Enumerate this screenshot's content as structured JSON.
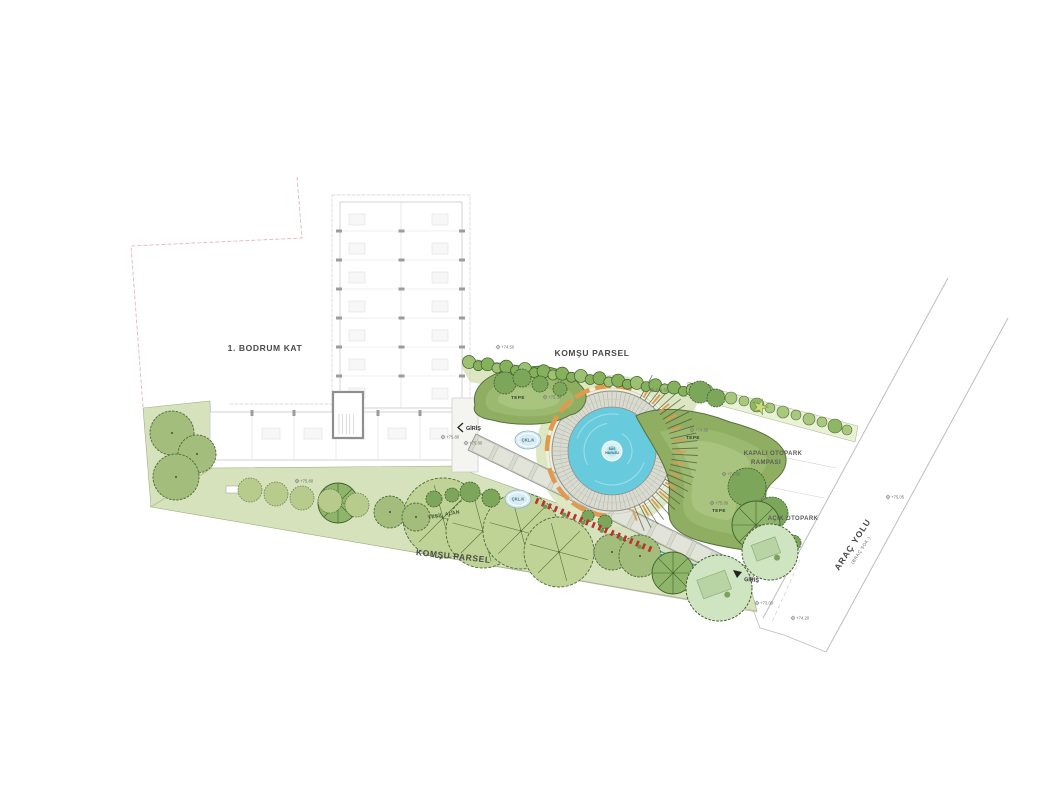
{
  "plan": {
    "floor_label": "1. BODRUM KAT",
    "neighbor_parcel_top": "KOMŞU PARSEL",
    "neighbor_parcel_bottom": "KOMŞU PARSEL",
    "road_label": "ARAÇ YOLU",
    "road_sublabel": "(BRAÇ SOK.)",
    "covered_parking_line1": "KAPALI OTOPARK",
    "covered_parking_line2": "RAMPASI",
    "open_parking": "AÇIK OTOPARK",
    "entrance_building": "GİRİŞ",
    "entrance_street": "GİRİŞ",
    "pool_label_line1": "SÜS",
    "pool_label_line2": "HAVUZU",
    "gravel_label": "ÇKL.K",
    "green_area_label": "YEŞİL ALAN",
    "hill_label": "TEPE",
    "colors": {
      "lawn": "#d6e2bb",
      "lawn_pale": "#e4ebcd",
      "plaza": "#eef0da",
      "strip": "#e9f1d6",
      "canopy_light": "#c0d396",
      "canopy_med": "#a3bd7c",
      "canopy_dark": "#7ca75b",
      "shrub": "#b7cb8d",
      "lawn_circle": "#cfe4c0",
      "mound": "#8fae62",
      "mound_light": "#9cb970",
      "mound_lighter": "#a9c47e",
      "water": "#68cadd",
      "deck": "#d9dbd1",
      "bench_orange": "#e09a50",
      "bench_red": "#c03030",
      "line_gray": "#9a9a9a",
      "outline_dark": "#4f6b38",
      "boundary_pink": "#e4b7ba"
    },
    "elevation_markers": [
      {
        "x": 443,
        "y": 437,
        "label": "75.80"
      },
      {
        "x": 466,
        "y": 443,
        "label": "75.80"
      },
      {
        "x": 297,
        "y": 481,
        "label": "75.80"
      },
      {
        "x": 545,
        "y": 397,
        "label": "75.30"
      },
      {
        "x": 712,
        "y": 503,
        "label": "75.30"
      },
      {
        "x": 692,
        "y": 430,
        "label": "74.50"
      },
      {
        "x": 724,
        "y": 474,
        "label": "74.50"
      },
      {
        "x": 757,
        "y": 603,
        "label": "73.00"
      },
      {
        "x": 793,
        "y": 618,
        "label": "74.20"
      },
      {
        "x": 888,
        "y": 497,
        "label": "75.05"
      },
      {
        "x": 498,
        "y": 347,
        "label": "74.50"
      },
      {
        "x": 652,
        "y": 390,
        "label": "74.50"
      }
    ],
    "hill_label_positions": [
      {
        "x": 518,
        "y": 399
      },
      {
        "x": 693,
        "y": 439
      },
      {
        "x": 719,
        "y": 512
      }
    ],
    "gravel_positions": [
      {
        "x": 528,
        "y": 440
      },
      {
        "x": 518,
        "y": 499
      }
    ],
    "trees": {
      "canopy_light": [
        [
          443,
          518,
          40
        ],
        [
          483,
          531,
          37
        ],
        [
          521,
          531,
          38
        ],
        [
          559,
          552,
          35
        ]
      ],
      "canopy_med": [
        [
          172,
          433,
          22
        ],
        [
          197,
          454,
          19
        ],
        [
          176,
          477,
          23
        ],
        [
          390,
          512,
          16
        ],
        [
          416,
          517,
          14
        ],
        [
          612,
          552,
          18
        ],
        [
          640,
          556,
          21
        ]
      ],
      "canopy_dark": [
        [
          470,
          492,
          10
        ],
        [
          491,
          498,
          9
        ],
        [
          434,
          499,
          8
        ],
        [
          452,
          495,
          7
        ],
        [
          505,
          383,
          11
        ],
        [
          522,
          378,
          9
        ],
        [
          540,
          384,
          8
        ],
        [
          560,
          389,
          7
        ],
        [
          700,
          392,
          11
        ],
        [
          716,
          398,
          9
        ],
        [
          747,
          487,
          19
        ],
        [
          772,
          513,
          16
        ],
        [
          793,
          543,
          8
        ],
        [
          605,
          522,
          7
        ],
        [
          588,
          516,
          6
        ]
      ],
      "conifer": [
        [
          338,
          503,
          20
        ],
        [
          673,
          573,
          21
        ],
        [
          756,
          525,
          24
        ]
      ],
      "shrub_row": [
        [
          250,
          490,
          12
        ],
        [
          276,
          494,
          12
        ],
        [
          302,
          498,
          12
        ],
        [
          330,
          501,
          12
        ],
        [
          357,
          505,
          12
        ]
      ],
      "lawn_circle": [
        [
          770,
          552,
          28
        ],
        [
          719,
          588,
          33
        ]
      ],
      "strip_shrubs": [
        [
          706,
          391,
          7
        ],
        [
          719,
          395,
          5
        ],
        [
          731,
          398,
          6
        ],
        [
          744,
          401,
          5
        ],
        [
          757,
          405,
          7
        ],
        [
          770,
          408,
          5
        ],
        [
          783,
          412,
          6
        ],
        [
          796,
          415,
          5
        ],
        [
          809,
          419,
          6
        ],
        [
          822,
          422,
          5
        ],
        [
          835,
          426,
          7
        ],
        [
          847,
          430,
          5
        ]
      ],
      "strip_star": [
        760,
        407
      ]
    },
    "hedge": {
      "x1": 469,
      "y1": 363,
      "x2": 702,
      "y2": 392,
      "count": 26
    },
    "red_benches": {
      "x1": 537,
      "y1": 501,
      "x2": 650,
      "y2": 549,
      "count": 19
    }
  }
}
